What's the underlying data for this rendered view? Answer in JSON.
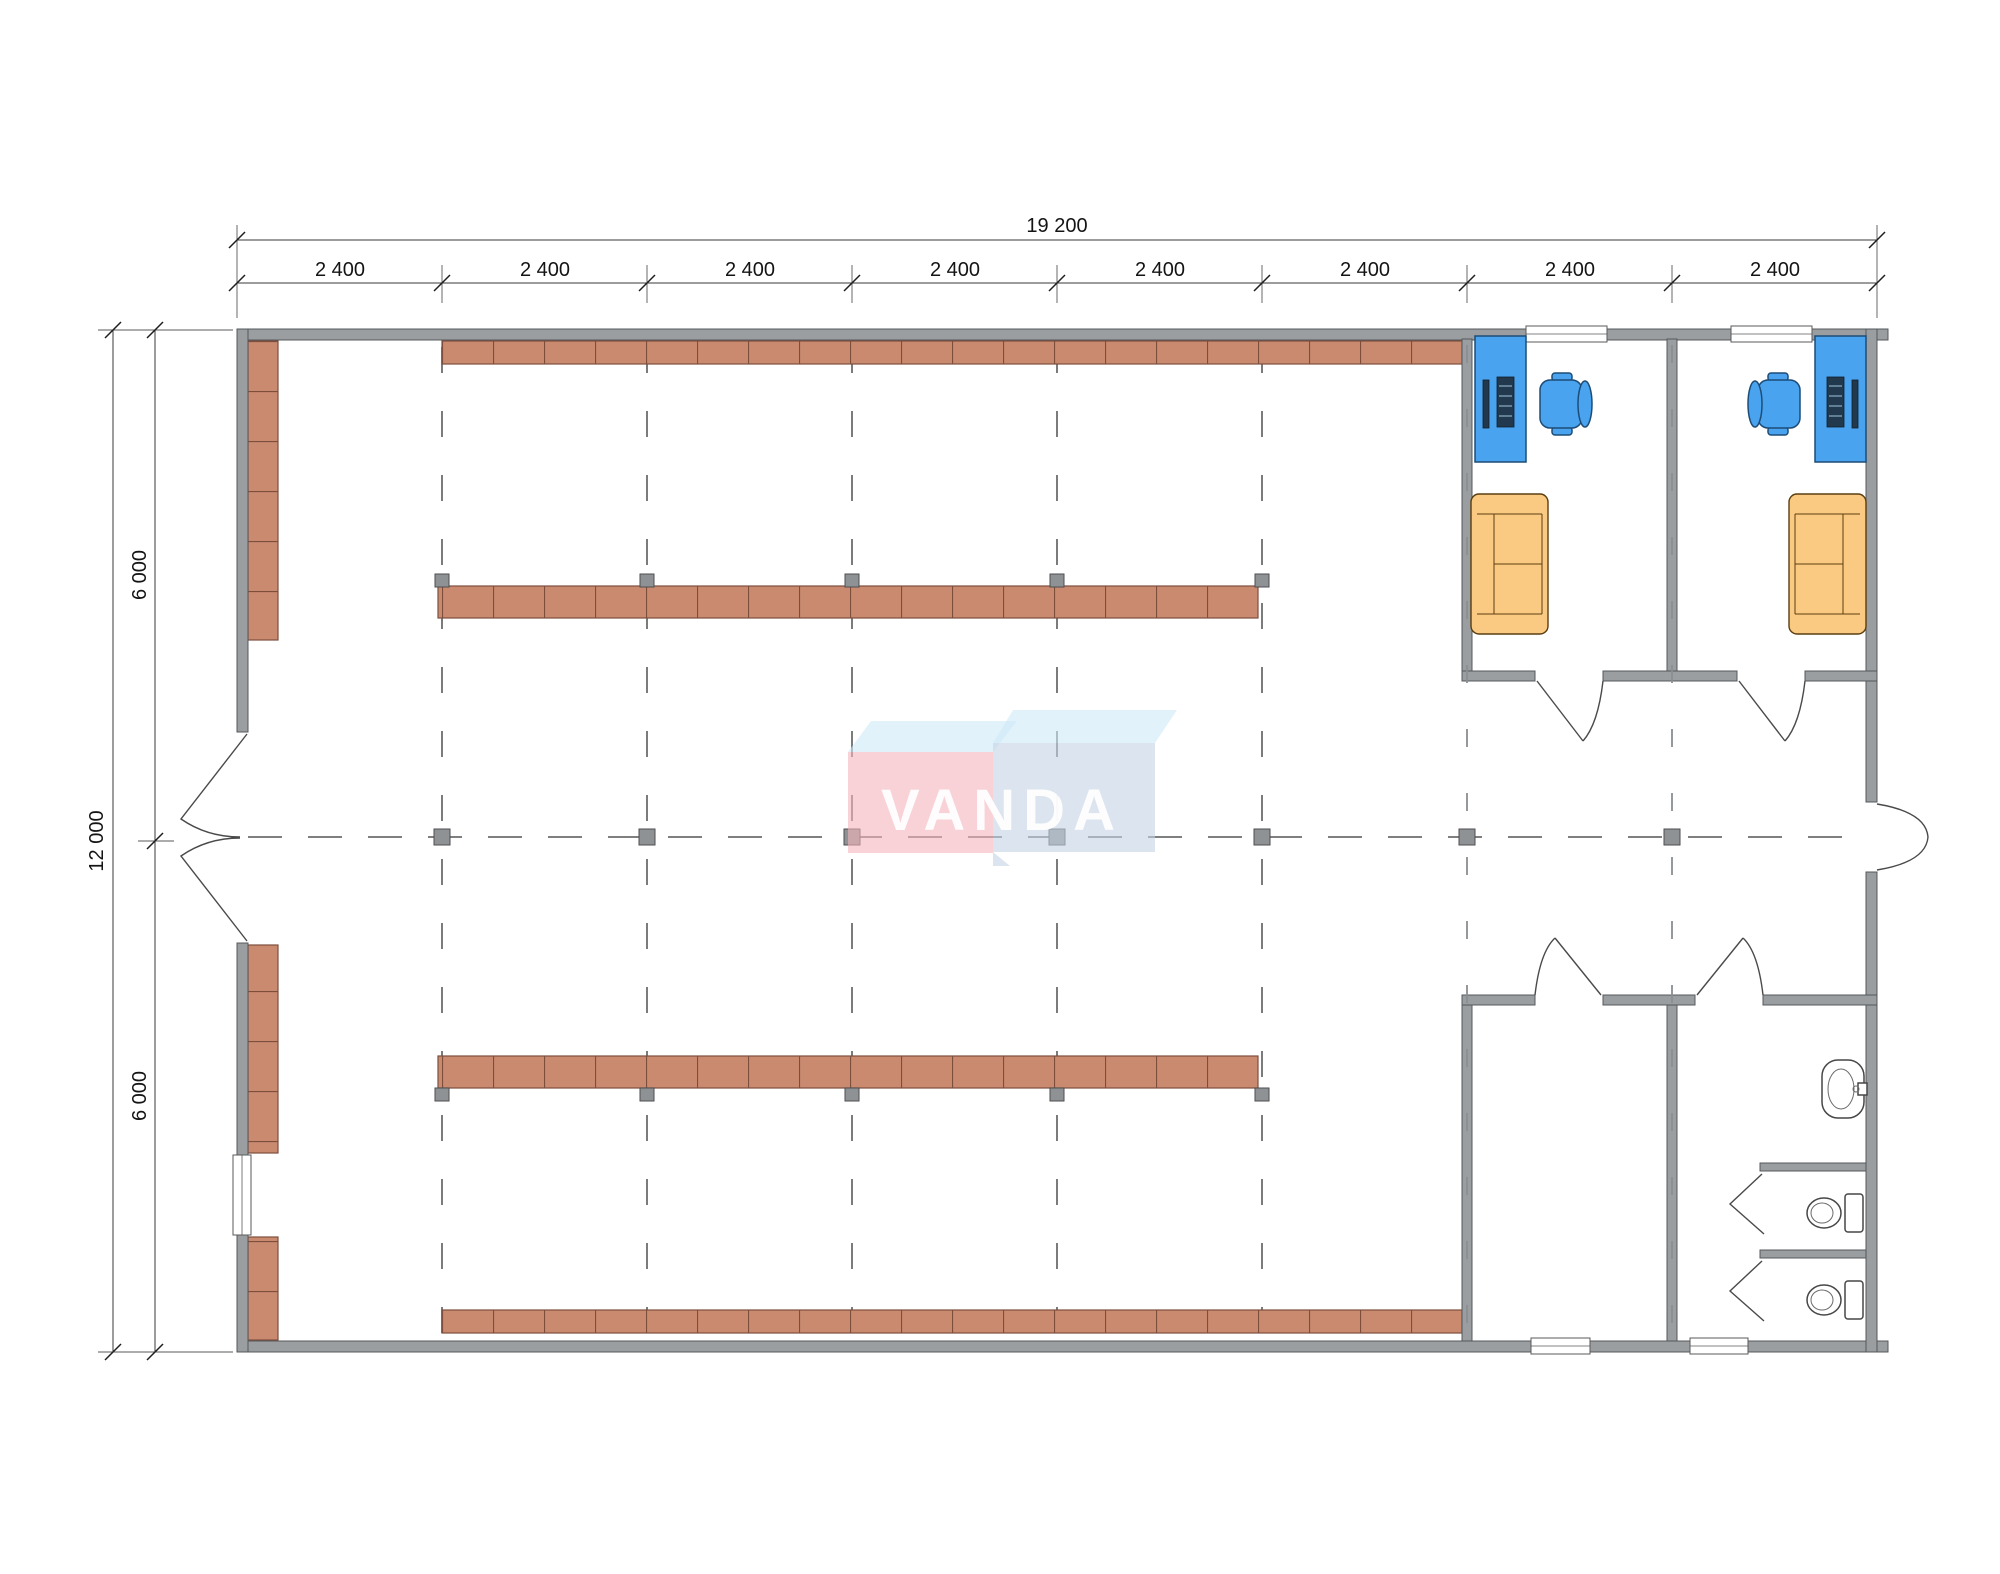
{
  "page": {
    "background": "#ffffff"
  },
  "dimensions": {
    "top_total": "19 200",
    "top_bays": [
      "2 400",
      "2 400",
      "2 400",
      "2 400",
      "2 400",
      "2 400",
      "2 400",
      "2 400"
    ],
    "left_total": "12 000",
    "left_halves": [
      "6 000",
      "6 000"
    ]
  },
  "logo": {
    "text": "VANDA"
  },
  "colors": {
    "wall": "#9b9ea0",
    "wall_stroke": "#55585c",
    "shelf": "#ca8a70",
    "shelf_line": "#7d4e3c",
    "blue": "#4aa3ef",
    "blue_stroke": "#1d4d77",
    "sofa": "#fbca82",
    "sofa_stroke": "#5a3e10",
    "grid": "#6d6d6d",
    "dim": "#3a3a3a",
    "logo_pink": "#f3b4ba",
    "logo_blue_top": "#cfe9f8",
    "logo_blue_front": "#c4d4e5"
  }
}
